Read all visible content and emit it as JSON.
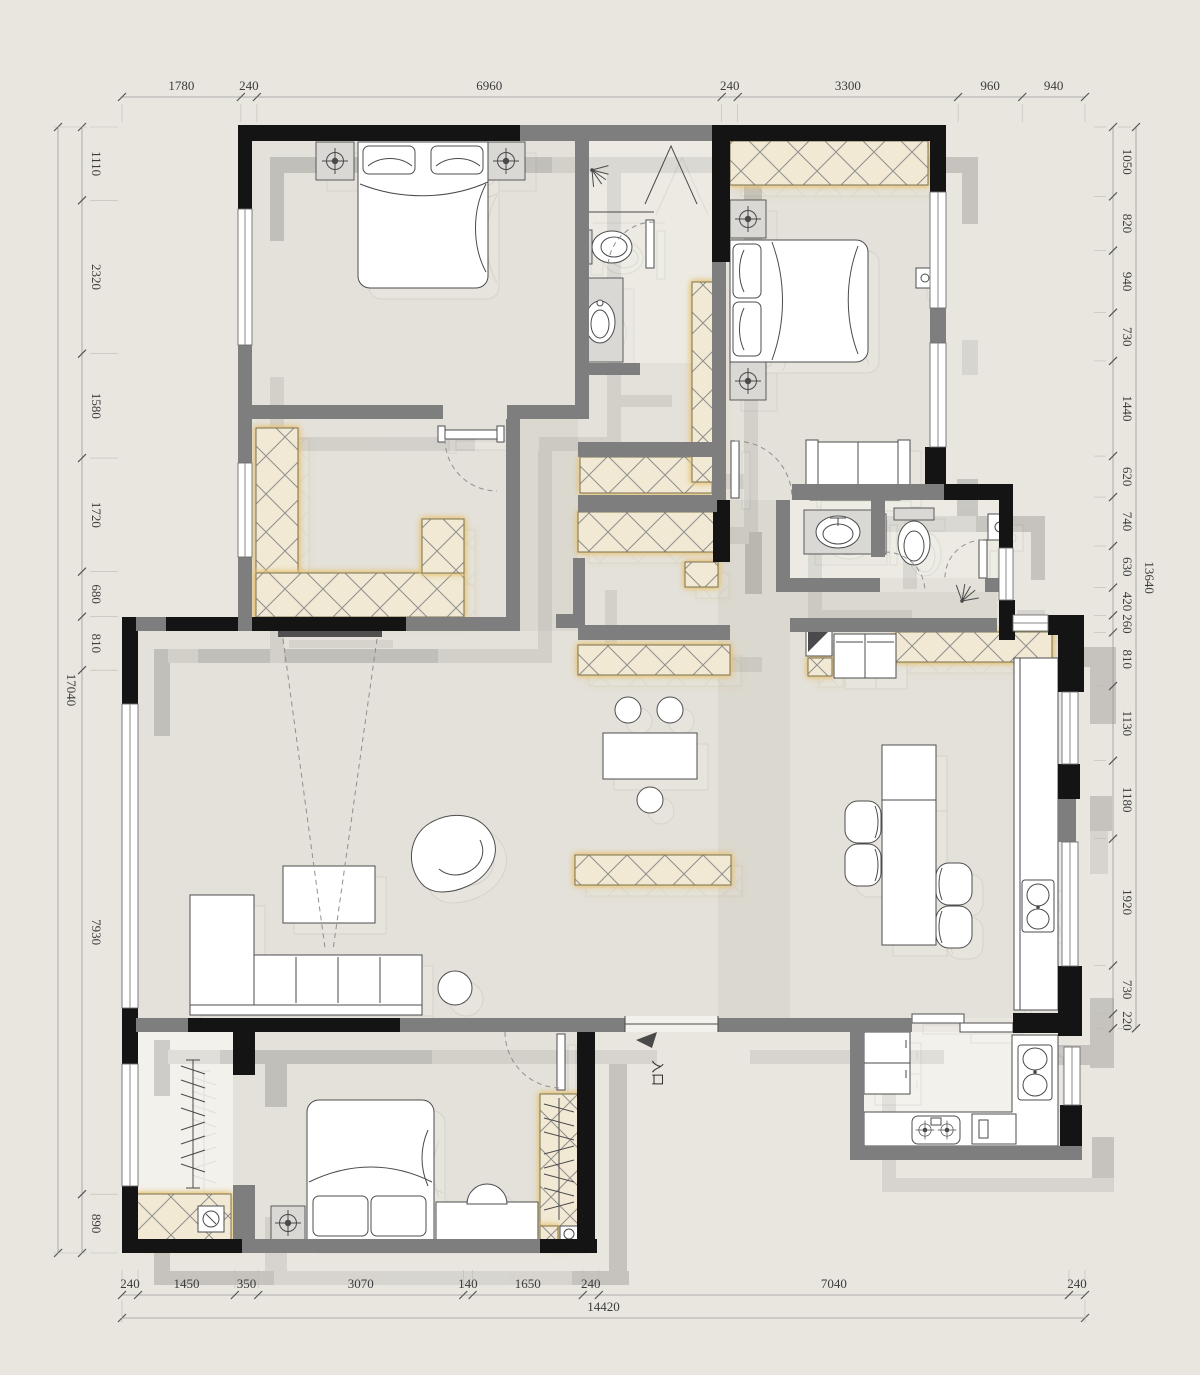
{
  "drawing": {
    "type": "residential-floor-plan",
    "entry_label": "入口"
  },
  "dims": {
    "top": {
      "segments": [
        "1780",
        "240",
        "6960",
        "240",
        "3300",
        "960",
        "940"
      ]
    },
    "bottom": {
      "segments": [
        "240",
        "1450",
        "350",
        "3070",
        "140",
        "1650",
        "240",
        "7040",
        "240"
      ],
      "total": "14420"
    },
    "left": {
      "segments": [
        "1110",
        "2320",
        "1580",
        "1720",
        "680",
        "810",
        "7930",
        "890"
      ],
      "total": "17040"
    },
    "right": {
      "segments": [
        "1050",
        "820",
        "940",
        "730",
        "1440",
        "620",
        "740",
        "630",
        "420",
        "260",
        "810",
        "1130",
        "1180",
        "1920",
        "730",
        "220"
      ],
      "total": "13640"
    }
  },
  "colors": {
    "background": "#e9e6e0",
    "floor": "#e4e1da",
    "floor_light": "#f3f1ec",
    "floor_bath": "#eceae3",
    "wall_black": "#141414",
    "wall_gray": "#7e7e7e",
    "cab_fill": "#f1e9d4",
    "cab_glow": "#e8c57a",
    "line": "#4a4a4a",
    "dim_text": "#3c3c3c"
  }
}
